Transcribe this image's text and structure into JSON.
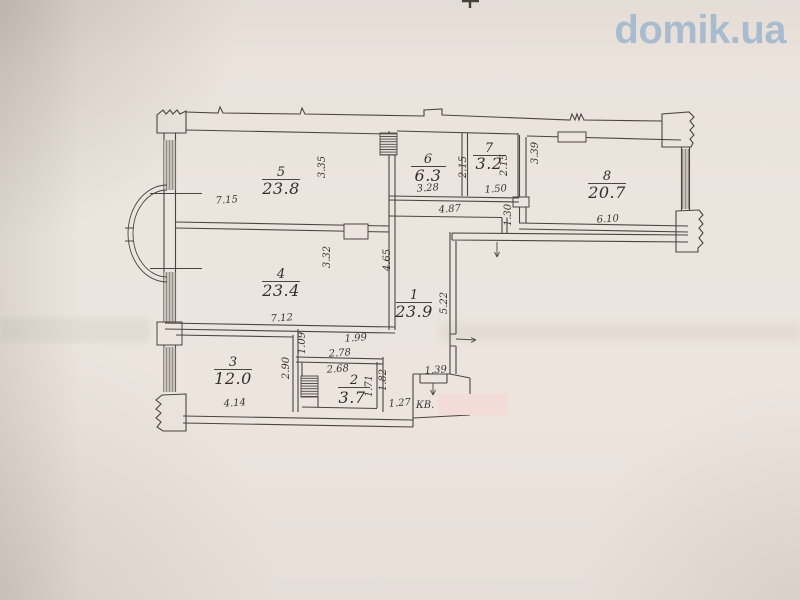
{
  "watermark": {
    "text": "domik.ua"
  },
  "plan": {
    "apartment_label": "КВ.",
    "rooms": {
      "r1": {
        "number": "1",
        "area": "23.9"
      },
      "r2": {
        "number": "2",
        "area": "3.7"
      },
      "r3": {
        "number": "3",
        "area": "12.0"
      },
      "r4": {
        "number": "4",
        "area": "23.4"
      },
      "r5": {
        "number": "5",
        "area": "23.8"
      },
      "r6": {
        "number": "6",
        "area": "6.3"
      },
      "r7": {
        "number": "7",
        "area": "3.2"
      },
      "r8": {
        "number": "8",
        "area": "20.7"
      }
    },
    "dims": {
      "room5_width": "7.15",
      "room5_depth": "3.35",
      "room6_width": "3.28",
      "room6_depth": "2.15",
      "room7_width": "1.50",
      "room7_depth": "2.15",
      "room8_width": "6.10",
      "room8_depth": "3.39",
      "hall_top_width": "4.87",
      "hall_top_depth": "1.30",
      "room4_width": "7.12",
      "room4_depth": "3.32",
      "hall_side_depth": "4.65",
      "hall_height": "5.22",
      "passage_width": "1.99",
      "passage_depth": "1.09",
      "room3_width": "4.14",
      "room3_depth": "2.90",
      "room2_top_width": "2.78",
      "room2_width": "2.68",
      "room2_depth": "1.71",
      "entry_depth": "1.82",
      "entry_width": "1.27",
      "vestibule_width": "1.39"
    }
  },
  "colors": {
    "paper": "#ebe3dc",
    "ink": "#4b4540",
    "watermark": "#a4bacf",
    "redaction": "#f3dcd8",
    "window_fill": "#c9c2ba"
  }
}
